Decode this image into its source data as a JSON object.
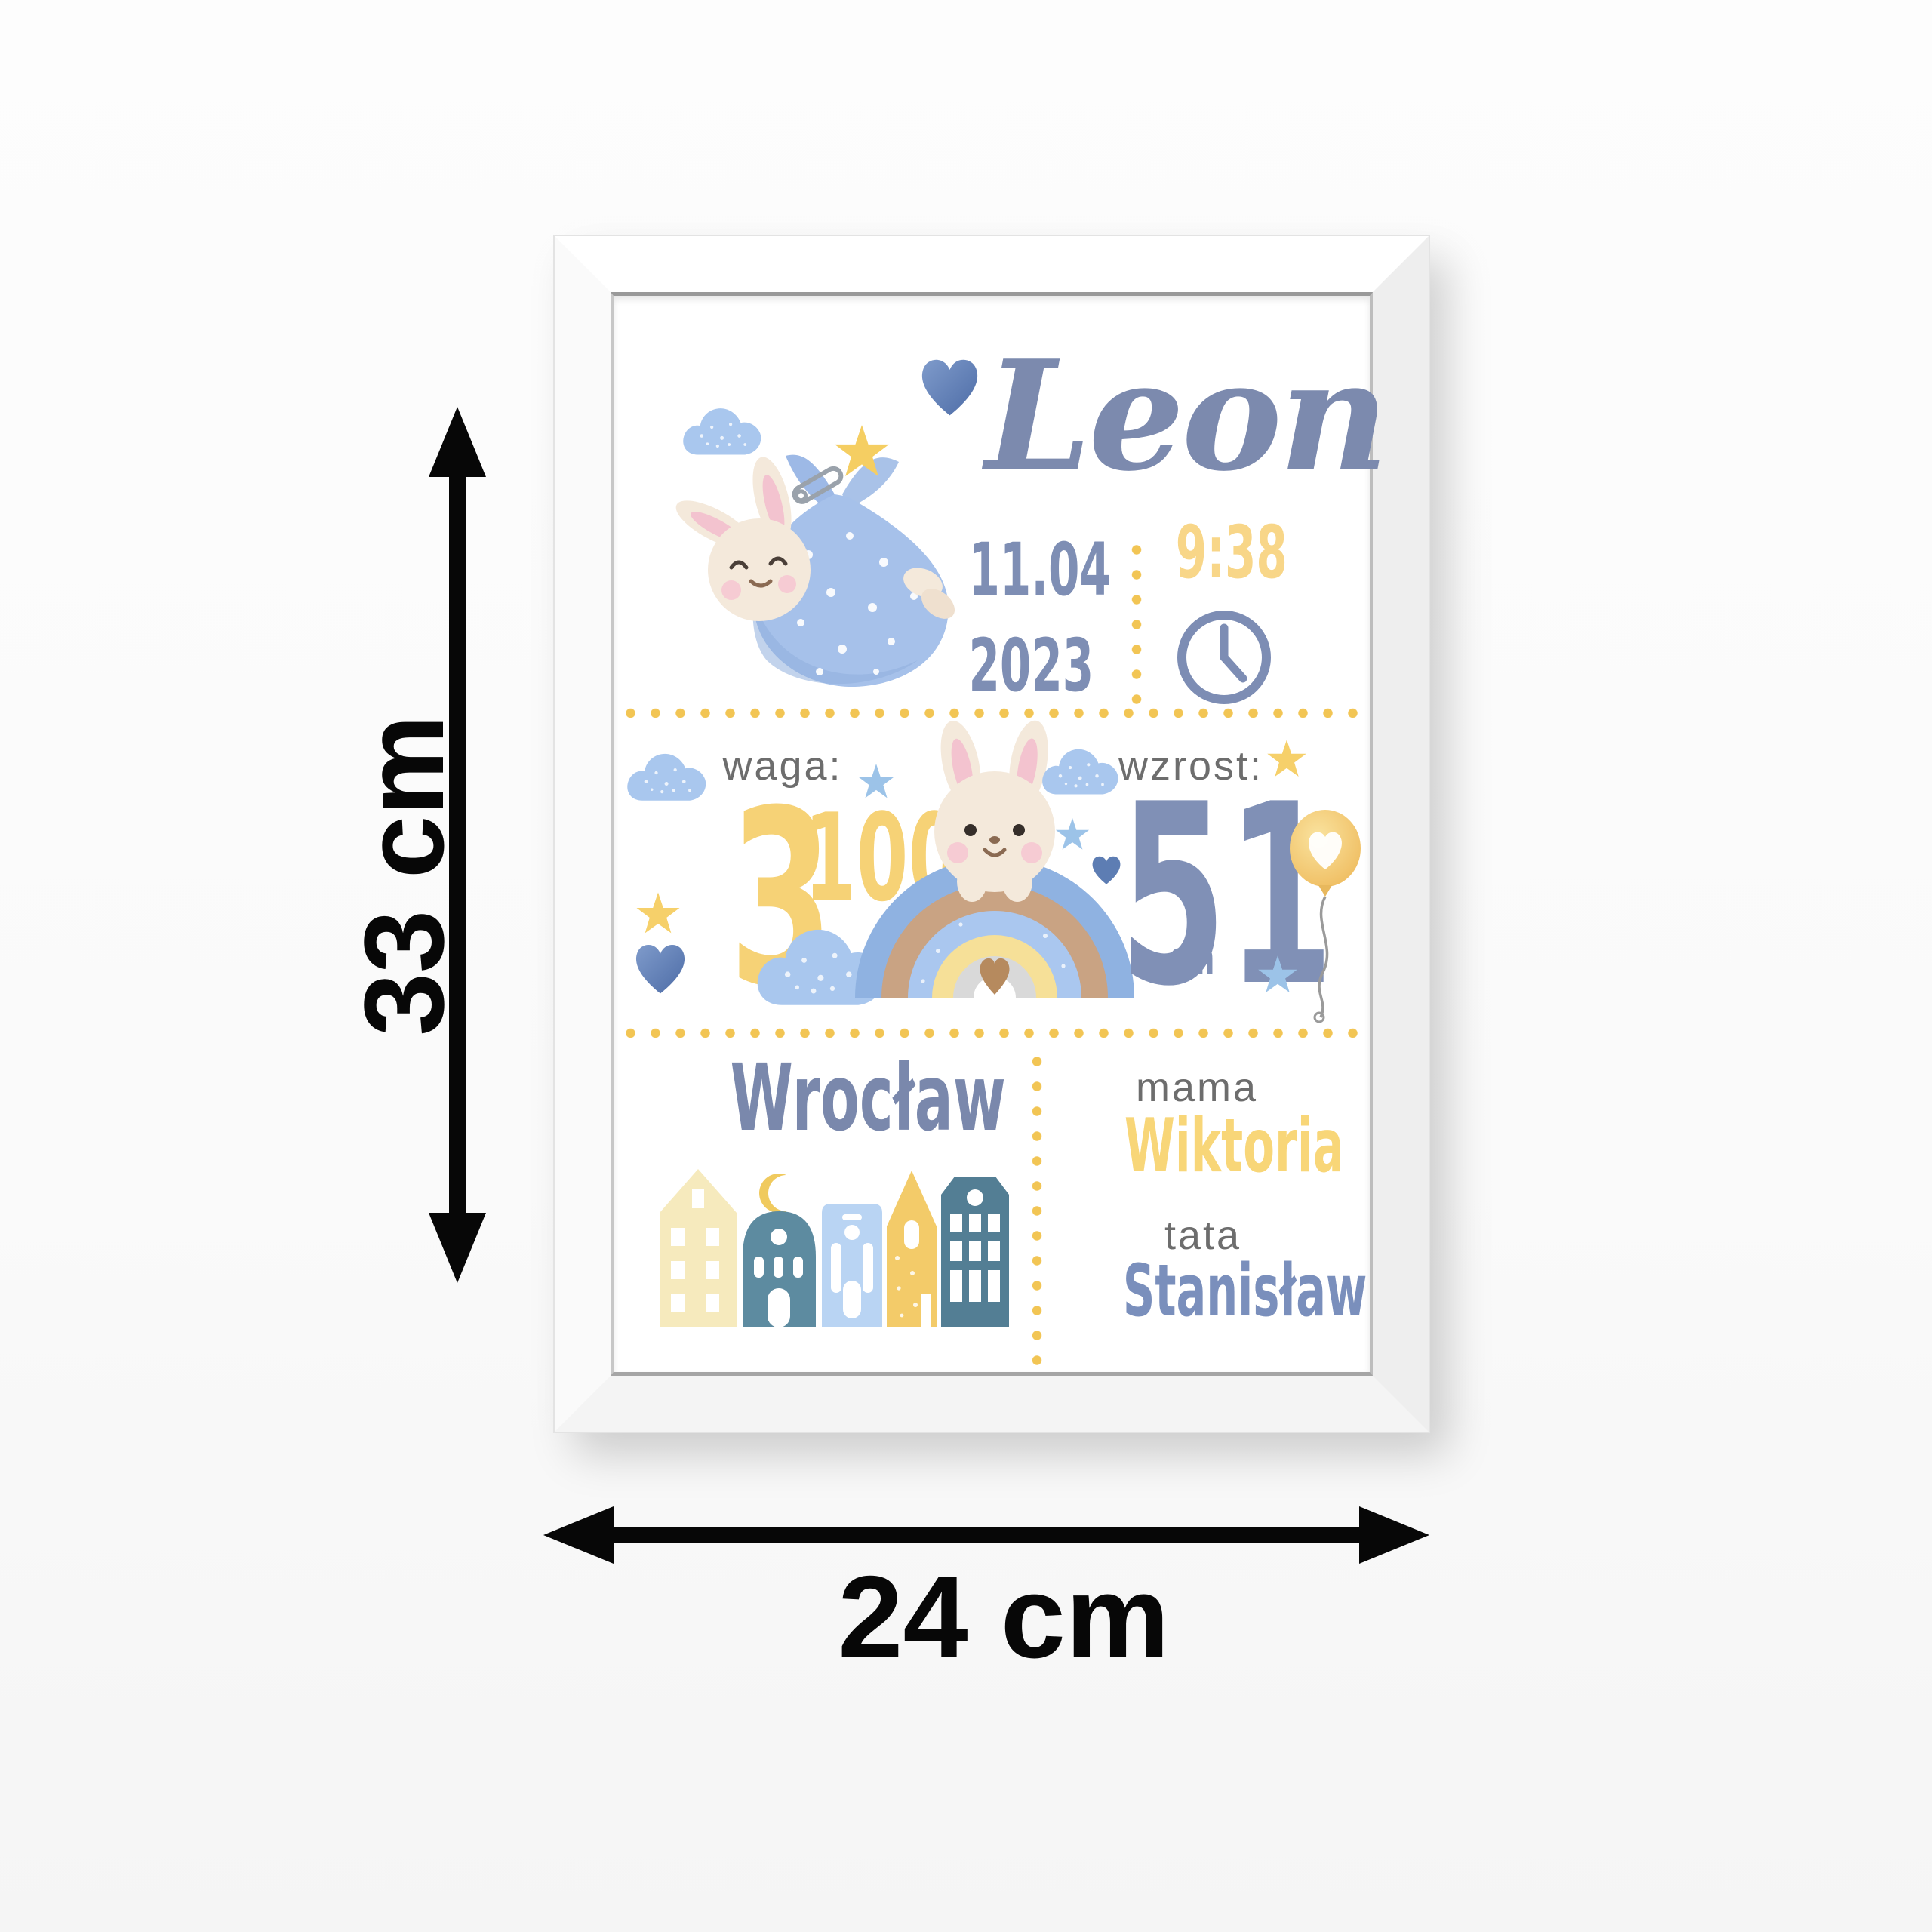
{
  "page": {
    "background": "#fdfdfd",
    "description": "framed baby birth announcement poster with size arrows"
  },
  "poster": {
    "name": "Leon",
    "birth": {
      "date_line1": "11.04",
      "date_line2": "2023",
      "time": "9:38"
    },
    "weight": {
      "label": "waga:",
      "value": "3",
      "sup": "100",
      "unit": "g"
    },
    "height": {
      "label": "wzrost:",
      "value": "51",
      "unit": "cm"
    },
    "city": "Wrocław",
    "parents": {
      "mom_label": "mama",
      "mom_name": "Wiktoria",
      "dad_label": "tata",
      "dad_name": "Stanisław"
    }
  },
  "dimensions": {
    "height_label": "33 cm",
    "width_label": "24 cm"
  },
  "icons": {
    "bunny_in_bundle": "bunny sleeping in hanging blue polka-dot bundle with star and safety pin",
    "bunny_on_rainbow": "bunny peeking over watercolor rainbow with heart",
    "cloud": "blue watercolor cloud with white speckles",
    "heart": "blue watercolor heart",
    "star_yellow": "yellow five-point star",
    "star_blue": "light blue five-point star",
    "clock": "clock outline showing hands",
    "balloon": "yellow balloon with white heart on string",
    "moon": "yellow crescent moon",
    "houses": "row of five scandinavian houses",
    "dimension_arrow": "black double-headed measurement arrow"
  },
  "colors": {
    "dot_yellow": "#F2C554",
    "text_blue": "#7E8EB4",
    "text_yellow": "#F7D383",
    "label_gray": "#6D6D6D",
    "cloud_blue": "#A9C7EE",
    "bundle_blue": "#A6C1EA",
    "bunny_cream": "#F4E9DB",
    "arrow_black": "#070707",
    "frame_white": "#FFFFFF"
  }
}
